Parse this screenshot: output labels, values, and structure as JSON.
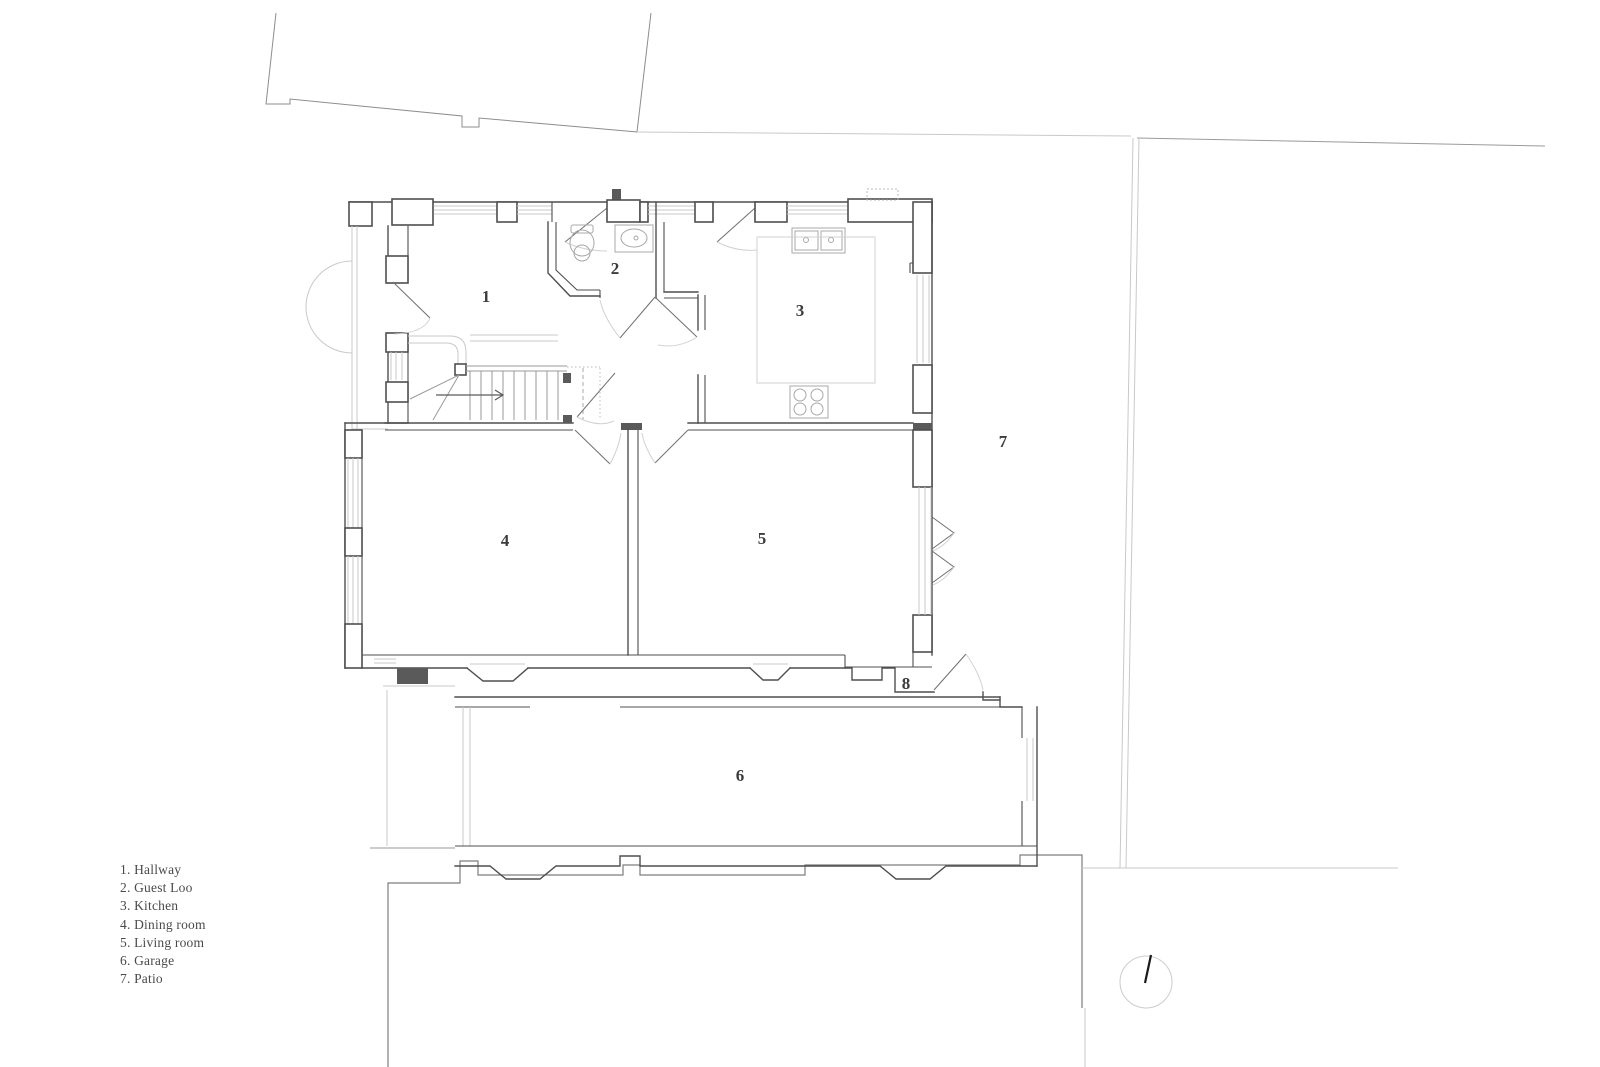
{
  "legend": {
    "items": [
      "1. Hallway",
      "2. Guest Loo",
      "3. Kitchen",
      "4. Dining room",
      "5. Living room",
      "6. Garage",
      "7. Patio"
    ]
  },
  "room_labels": [
    {
      "name": "hallway",
      "number": "1"
    },
    {
      "name": "guest-loo",
      "number": "2"
    },
    {
      "name": "kitchen",
      "number": "3"
    },
    {
      "name": "dining-room",
      "number": "4"
    },
    {
      "name": "living-room",
      "number": "5"
    },
    {
      "name": "garage",
      "number": "6"
    },
    {
      "name": "patio",
      "number": "7"
    },
    {
      "name": "back-porch",
      "number": "8"
    }
  ],
  "colors": {
    "wall": "#4f4f4f",
    "boundary": "#8c8c8c",
    "light_lines": "#c9c9c9",
    "label_text": "#3c3c3c",
    "background": "#ffffff"
  }
}
